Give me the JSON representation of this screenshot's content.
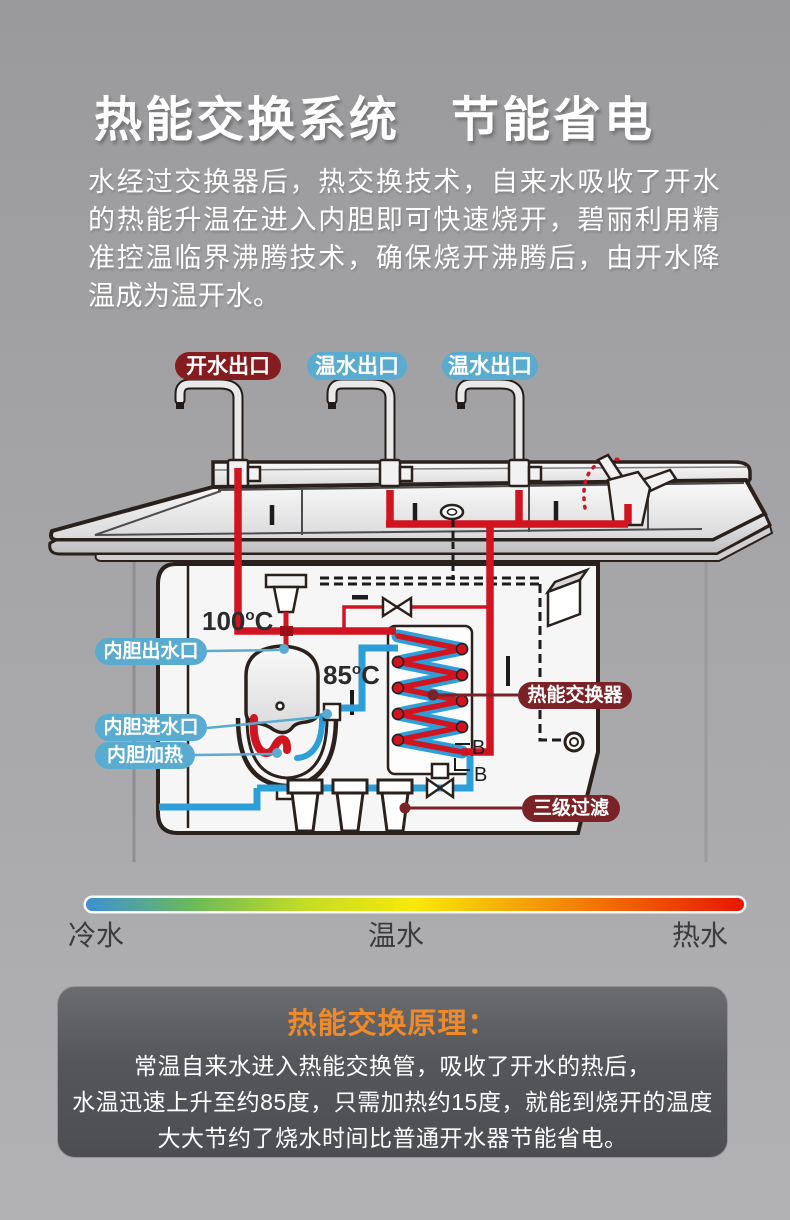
{
  "header": {
    "title": "热能交换系统　节能省电",
    "description": "水经过交换器后，热交换技术，自来水吸收了开水的热能升温在进入内胆即可快速烧开，碧丽利用精准控温临界沸腾技术，确保烧开沸腾后，由开水降温成为温开水。"
  },
  "diagram": {
    "outlets": [
      "开水出口",
      "温水出口",
      "温水出口"
    ],
    "tank_labels": [
      "内胆出水口",
      "内胆进水口",
      "内胆加热"
    ],
    "exchanger_label": "热能交换器",
    "filter_label": "三级过滤",
    "temps": {
      "boil": "100",
      "warm": "85",
      "degree": "o",
      "unit": "C"
    },
    "b_marks": [
      "B",
      "B"
    ],
    "colors": {
      "hot_pipe": "#d01420",
      "cold_pipe": "#2d9fd8",
      "label_blue": "#5aabd0",
      "label_maroon": "#7b2227",
      "label_dark_red": "#851c20",
      "outline": "#2a211c"
    }
  },
  "scale": {
    "cold": "冷水",
    "warm": "温水",
    "hot": "热水",
    "gradient": [
      "#3E90D4",
      "#6CBB57",
      "#C4DC26",
      "#F8E908",
      "#F6A206",
      "#F05B04",
      "#E81600"
    ]
  },
  "principle": {
    "title": "热能交换原理：",
    "title_color": "#ef8a2b",
    "lines": [
      "常温自来水进入热能交换管，吸收了开水的热后，",
      "水温迅速上升至约85度，只需加热约15度，就能到烧开的温度",
      "大大节约了烧水时间比普通开水器节能省电。"
    ]
  }
}
